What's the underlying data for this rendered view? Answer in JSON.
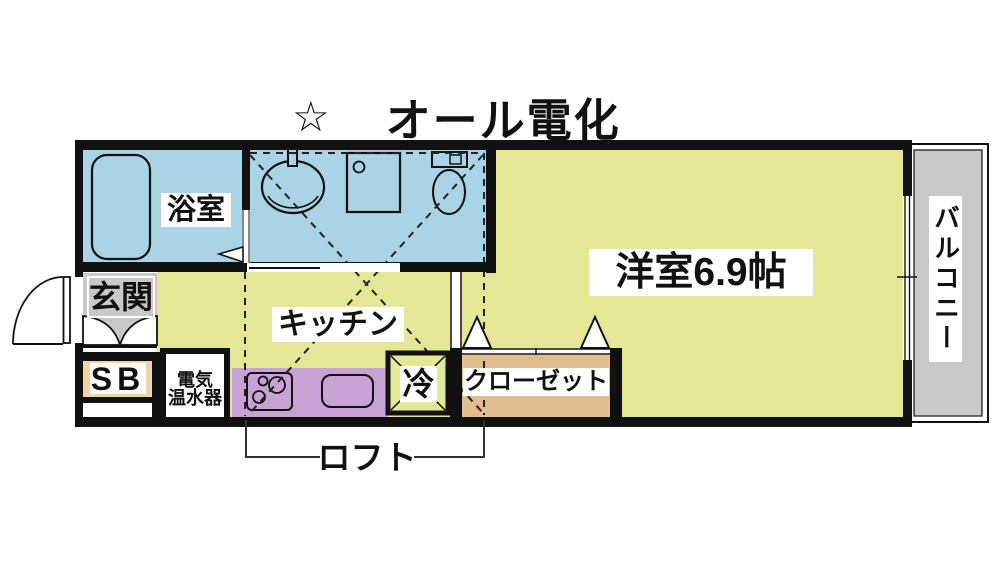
{
  "title": {
    "star": "☆",
    "text": "オール電化"
  },
  "rooms": {
    "bathroom": "浴室",
    "kitchen": "キッチン",
    "western_room": "洋室6.9帖",
    "closet": "クローゼット",
    "fridge": "冷",
    "entrance": "玄関",
    "shoe_box": "SB",
    "water_heater_line1": "電気",
    "water_heater_line2": "温水器",
    "balcony": "バルコニー",
    "loft": "ロフト"
  },
  "colors": {
    "wet_area_blue": "#aad3e5",
    "room_yellow": "#e3e796",
    "counter_purple": "#c8a2d5",
    "closet_tan": "#e2bd90",
    "shoebox_tan": "#efd4a7",
    "concrete_gray": "#c9c9c9",
    "wall_black": "#111111"
  }
}
